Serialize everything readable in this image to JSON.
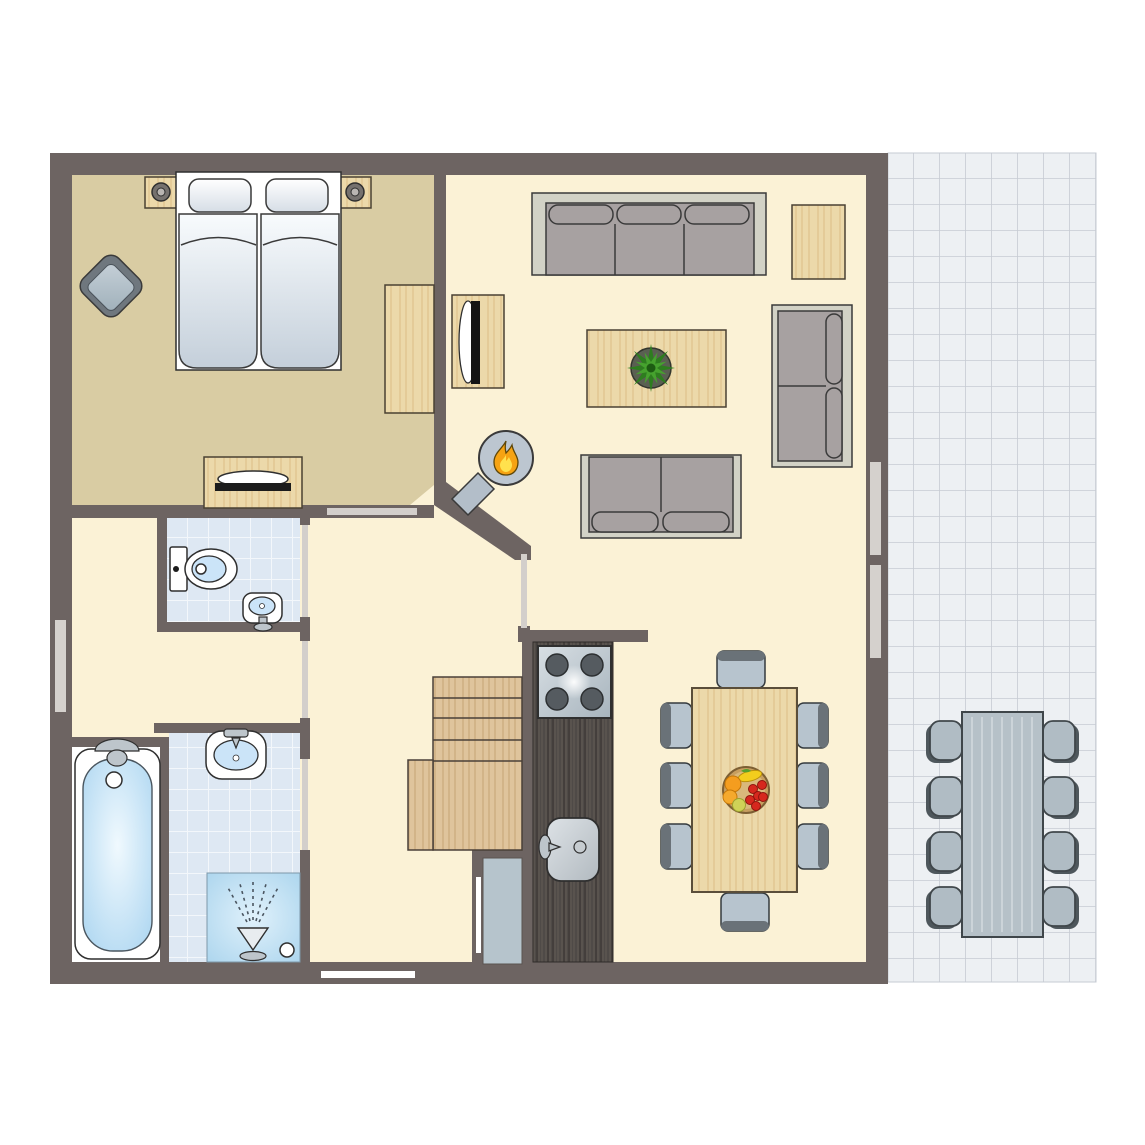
{
  "title": "Apartment floor plan with terrace",
  "palette": {
    "wall": "#6d6462",
    "floorMain": "#fbf2d6",
    "floorBedroom": "#d9cca3",
    "tileBath": "#dee8f3",
    "tileTerrace": "#edf0f3",
    "tileGrout": "#c6cbd3",
    "woodLight": "#ecd9aa",
    "woodStair": "#dfc49c",
    "woodDark": "#4f4a47",
    "sofaBase": "#d2d2c6",
    "sofaCushion": "#a7a1a1",
    "chairSeat": "#b7c4ce",
    "chairBack": "#6a7278",
    "outdoorSeat": "#b0bcc4",
    "outdoorTable": "#b6c1c8",
    "waterBlue": "#cbe4f8",
    "stoveBurner": "#555b60",
    "flameOrange": "#f6a313",
    "flameYellow": "#ffe14d",
    "plantGreen": "#2e7d1f",
    "bowlTan": "#c79e5f",
    "doorStrip": "#d3cfcb",
    "windowStrip": "#d5d1cd",
    "entryDoor": "#b6c4cc",
    "outline": "#3a3a3a"
  },
  "rooms": [
    {
      "id": "bedroom",
      "floor": "wood-tan"
    },
    {
      "id": "living-room",
      "floor": "cream"
    },
    {
      "id": "hallway",
      "floor": "cream"
    },
    {
      "id": "wc",
      "floor": "blue-tiles"
    },
    {
      "id": "bathroom",
      "floor": "blue-tiles"
    },
    {
      "id": "entry-hall",
      "floor": "cream"
    },
    {
      "id": "kitchen",
      "floor": "cream"
    },
    {
      "id": "dining-area",
      "floor": "cream"
    },
    {
      "id": "terrace",
      "floor": "white-tiles"
    }
  ],
  "furniture": {
    "bedroom": [
      "double-bed",
      "pillows-2",
      "nightstands-2",
      "bedside-lamps-2",
      "armchair",
      "desk",
      "dresser-with-tv"
    ],
    "living_room": [
      "sofa-3-seat",
      "sofa-2-seat-right",
      "sofa-2-seat-bottom",
      "coffee-table",
      "potted-plant",
      "side-table",
      "tv-stand",
      "wood-stove"
    ],
    "wc": [
      "toilet",
      "hand-basin"
    ],
    "bathroom": [
      "bathtub",
      "washbasin",
      "shower"
    ],
    "kitchen": [
      "dark-counter",
      "stove-4-burners",
      "kitchen-sink"
    ],
    "entry_hall": [
      "staircase",
      "entry-door"
    ],
    "dining_area": [
      "dining-table",
      "dining-chairs-8",
      "fruit-bowl"
    ],
    "terrace": [
      "outdoor-table",
      "outdoor-chairs-8"
    ]
  },
  "icons": [
    "flame-icon",
    "plant-icon",
    "shower-spray-icon",
    "fruit-bowl-icon",
    "lamp-icon"
  ],
  "counts": {
    "dining_chairs": 8,
    "terrace_chairs": 8,
    "stove_burners": 4,
    "windows": 4,
    "interior_doors": 5
  }
}
